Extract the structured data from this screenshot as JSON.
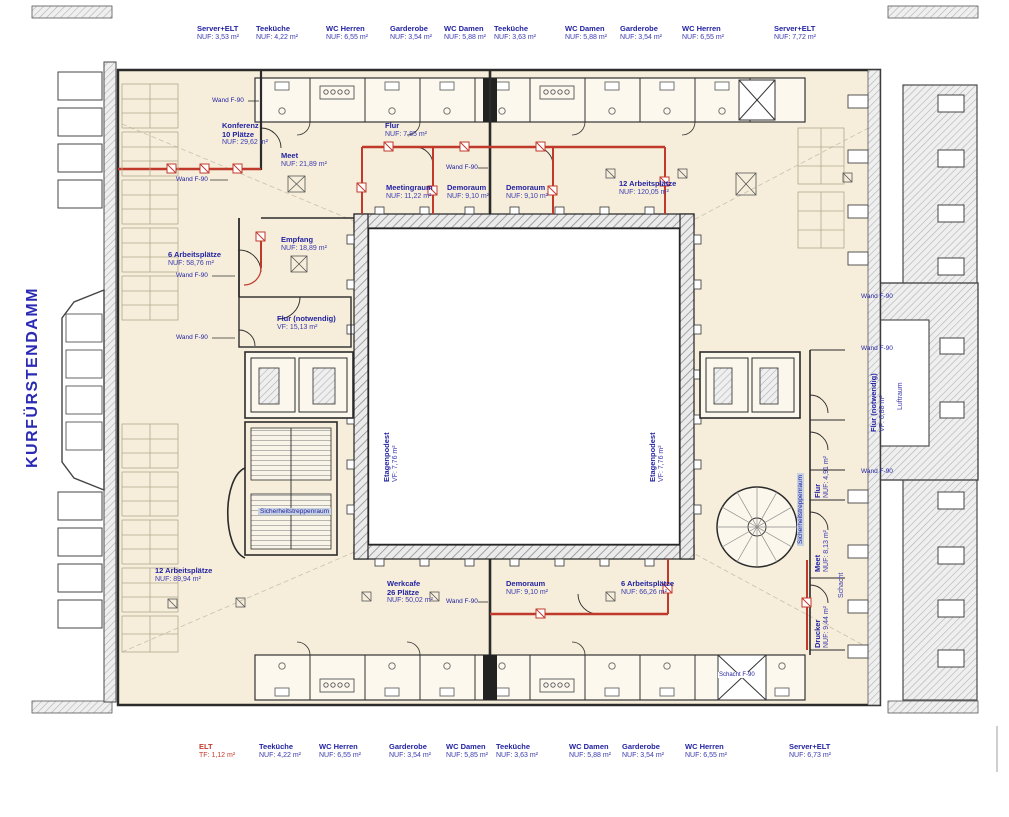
{
  "street_label": "KURFÜRSTENDAMM",
  "colors": {
    "label_blue": "#2323a2",
    "red_wall": "#c0392b",
    "floor_cream": "#f6eedb"
  },
  "top_strip": [
    {
      "name": "Server+ELT",
      "area": "NUF: 3,53 m²"
    },
    {
      "name": "Teeküche",
      "area": "NUF: 4,22 m²"
    },
    {
      "name": "WC Herren",
      "area": "NUF: 6,55 m²"
    },
    {
      "name": "Garderobe",
      "area": "NUF: 3,54 m²"
    },
    {
      "name": "WC Damen",
      "area": "NUF: 5,88 m²"
    },
    {
      "name": "Teeküche",
      "area": "NUF: 3,63 m²"
    },
    {
      "name": "WC Damen",
      "area": "NUF: 5,88 m²"
    },
    {
      "name": "Garderobe",
      "area": "NUF: 3,54 m²"
    },
    {
      "name": "WC Herren",
      "area": "NUF: 6,55 m²"
    },
    {
      "name": "Server+ELT",
      "area": "NUF: 7,72 m²"
    }
  ],
  "bottom_strip": [
    {
      "name": "ELT",
      "area": "TF: 1,12 m²"
    },
    {
      "name": "Teeküche",
      "area": "NUF: 4,22 m²"
    },
    {
      "name": "WC Herren",
      "area": "NUF: 6,55 m²"
    },
    {
      "name": "Garderobe",
      "area": "NUF: 3,54 m²"
    },
    {
      "name": "WC Damen",
      "area": "NUF: 5,85 m²"
    },
    {
      "name": "Teeküche",
      "area": "NUF: 3,63 m²"
    },
    {
      "name": "WC Damen",
      "area": "NUF: 5,88 m²"
    },
    {
      "name": "Garderobe",
      "area": "NUF: 3,54 m²"
    },
    {
      "name": "WC Herren",
      "area": "NUF: 6,55 m²"
    },
    {
      "name": "Server+ELT",
      "area": "NUF: 6,73 m²"
    }
  ],
  "rooms": {
    "konferenz": {
      "name": "Konferenz",
      "line2": "10 Plätze",
      "area": "NUF: 29,62 m²"
    },
    "meet_nw": {
      "name": "Meet",
      "area": "NUF: 21,89 m²"
    },
    "flur_top": {
      "name": "Flur",
      "area": "NUF: 7,85 m²"
    },
    "meetingraum": {
      "name": "Meetingraum",
      "area": "NUF: 11,22 m²"
    },
    "demoraum_1": {
      "name": "Demoraum",
      "area": "NUF: 9,10 m²"
    },
    "demoraum_2": {
      "name": "Demoraum",
      "area": "NUF: 9,10 m²"
    },
    "arbeitsplaetze_12_nord": {
      "name": "12 Arbeitsplätze",
      "area": "NUF: 120,05 m²"
    },
    "empfang": {
      "name": "Empfang",
      "area": "NUF: 18,89 m²"
    },
    "arbeitsplaetze_6_west": {
      "name": "6 Arbeitsplätze",
      "area": "NUF: 58,76 m²"
    },
    "flur_notwendig_west": {
      "name": "Flur (notwendig)",
      "area": "VF: 15,13 m²"
    },
    "etagenpodest_west": {
      "name": "Etagenpodest",
      "area": "VF: 7,76 m²"
    },
    "etagenpodest_ost": {
      "name": "Etagenpodest",
      "area": "VF: 7,76 m²"
    },
    "arbeitsplaetze_12_sued": {
      "name": "12 Arbeitsplätze",
      "area": "NUF: 89,94 m²"
    },
    "werkcafe": {
      "name": "Werkcafe",
      "line2": "26 Plätze",
      "area": "NUF: 50,02 m²"
    },
    "demoraum_sued": {
      "name": "Demoraum",
      "area": "NUF: 9,10 m²"
    },
    "arbeitsplaetze_6_sued": {
      "name": "6 Arbeitsplätze",
      "area": "NUF: 66,26 m²"
    },
    "flur_ost": {
      "name": "Flur",
      "area": "NUF: 4,91 m²"
    },
    "meet_ost": {
      "name": "Meet",
      "area": "NUF: 8,13 m²"
    },
    "drucker": {
      "name": "Drucker",
      "area": "NUF: 9,44 m²"
    },
    "flur_notwendig_ost": {
      "name": "Flur (notwendig)",
      "area": "VF: 6,88 m²"
    },
    "luftraum": {
      "name": "Luftraum"
    }
  },
  "annotations": {
    "wand_f90": "Wand F-90",
    "schacht_f90": "Schacht F-90",
    "schacht": "Schacht",
    "sicherheitstreppenraum": "Sicherheitstreppenraum"
  }
}
